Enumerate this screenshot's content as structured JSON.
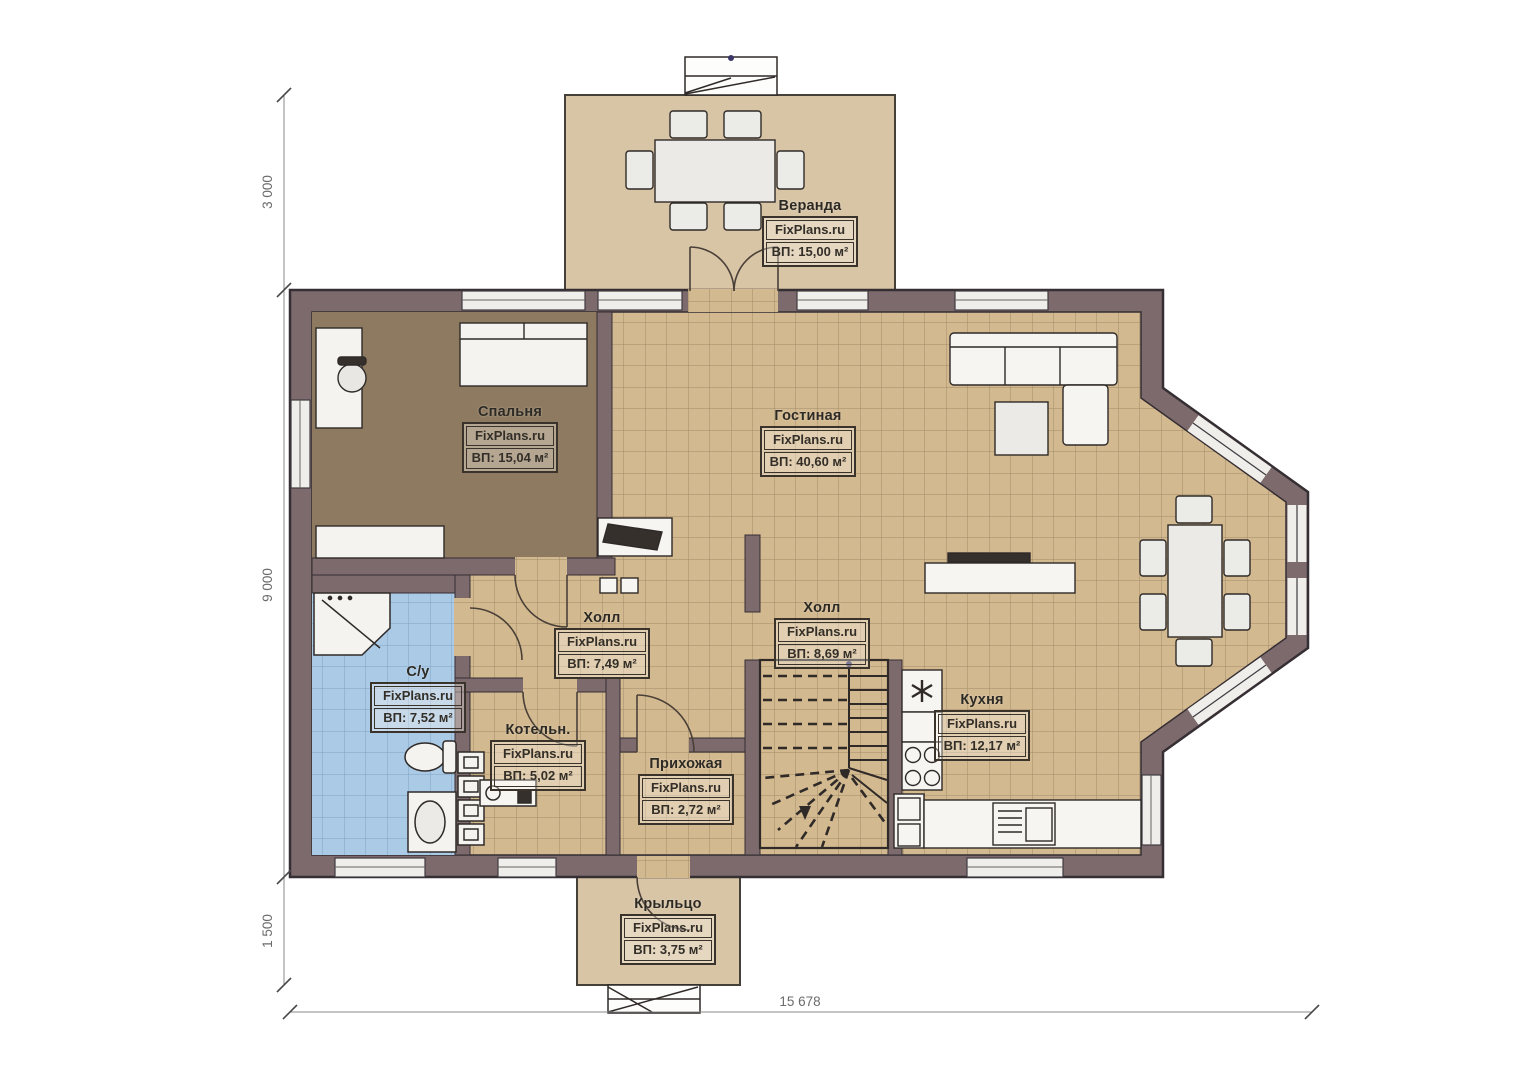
{
  "watermark": "FixPlans.ru",
  "rooms": {
    "veranda": {
      "name": "Веранда",
      "area": "ВП: 15,00 м²"
    },
    "bedroom": {
      "name": "Спальня",
      "area": "ВП: 15,04 м²"
    },
    "living": {
      "name": "Гостиная",
      "area": "ВП: 40,60 м²"
    },
    "hall1": {
      "name": "Холл",
      "area": "ВП: 7,49 м²"
    },
    "hall2": {
      "name": "Холл",
      "area": "ВП: 8,69 м²"
    },
    "bathroom": {
      "name": "С/у",
      "area": "ВП: 7,52 м²"
    },
    "boiler": {
      "name": "Котельн.",
      "area": "ВП: 5,02 м²"
    },
    "entry": {
      "name": "Прихожая",
      "area": "ВП: 2,72 м²"
    },
    "kitchen": {
      "name": "Кухня",
      "area": "ВП: 12,17 м²"
    },
    "porch": {
      "name": "Крыльцо",
      "area": "ВП: 3,75 м²"
    }
  },
  "dimensions": {
    "veranda_depth": "3 000",
    "house_depth": "9 000",
    "porch_depth": "1 500",
    "total_width": "15 678"
  },
  "colors": {
    "wall": "#7d6a6d",
    "floor_tile": "#d3b98f",
    "bathroom_tile": "#abcae6",
    "bedroom_floor": "#8e7a60",
    "veranda_floor": "#d8c5a6"
  }
}
